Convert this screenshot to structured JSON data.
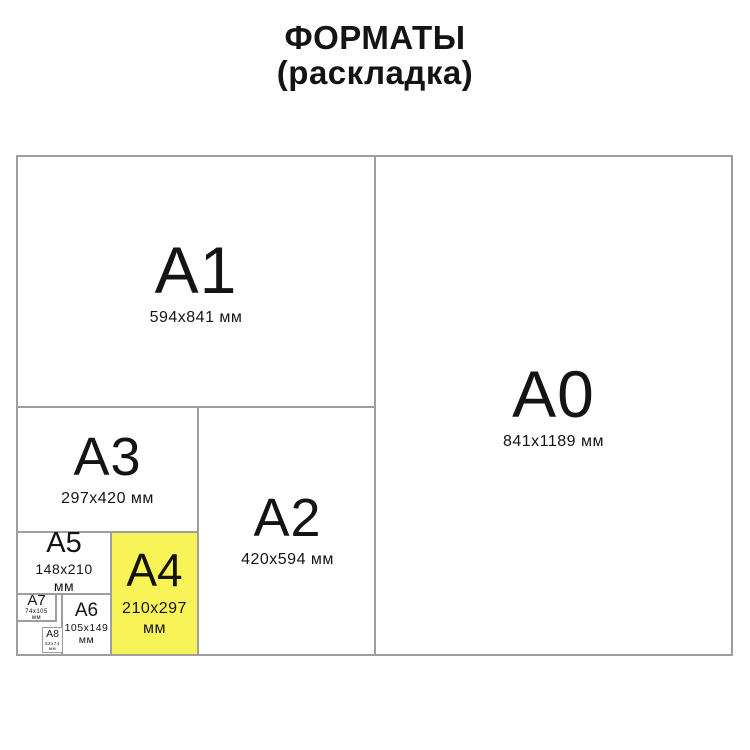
{
  "title": {
    "line1": "ФОРМАТЫ",
    "line2": "(раскладка)"
  },
  "colors": {
    "highlight_yellow": "#f8f356",
    "line_gray": "#9e9e9e",
    "text": "#141414"
  },
  "highlighted_format": "A4",
  "formats": {
    "a0": {
      "label": "A0",
      "dims": "841x1189 мм"
    },
    "a1": {
      "label": "A1",
      "dims": "594x841 мм"
    },
    "a2": {
      "label": "A2",
      "dims": "420x594 мм"
    },
    "a3": {
      "label": "A3",
      "dims": "297x420 мм"
    },
    "a4": {
      "label": "A4",
      "dims": "210x297",
      "unit": "мм"
    },
    "a5": {
      "label": "A5",
      "dims": "148x210",
      "unit": "мм"
    },
    "a6": {
      "label": "A6",
      "dims": "105x149",
      "unit": "мм"
    },
    "a7": {
      "label": "A7",
      "dims": "74x105",
      "unit": "мм"
    },
    "a8": {
      "label": "A8",
      "dims": "52x74",
      "unit": "мм"
    }
  }
}
